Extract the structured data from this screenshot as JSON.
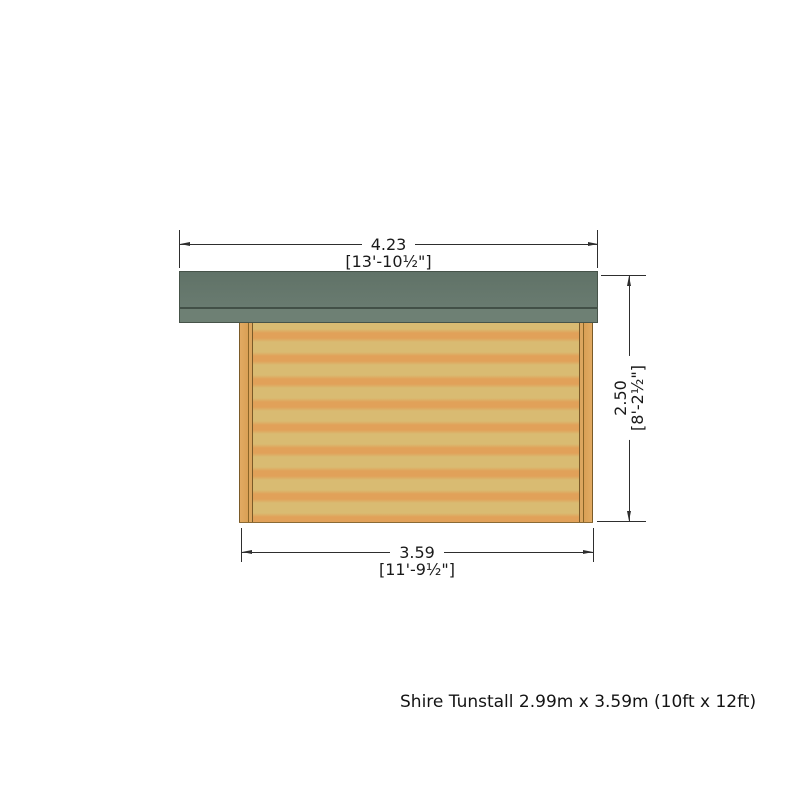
{
  "drawing": {
    "title": "side elevation of log cabin",
    "dims": {
      "top": {
        "metric": "4.23",
        "imperial": "[13'-10½\"]"
      },
      "right": {
        "metric": "2.50",
        "imperial": "[8'-2½\"]"
      },
      "bottom": {
        "metric": "3.59",
        "imperial": "[11'-9½\"]"
      }
    },
    "caption": "Shire Tunstall 2.99m x 3.59m (10ft x 12ft)",
    "colors": {
      "roof": "#697b70",
      "roof_fascia": "#6e8074",
      "roof_edge": "#465349",
      "wall_light": "#d9bb72",
      "wall_orange": "#e1a159",
      "post": "#dca65f",
      "post_edge": "#7a5a28",
      "line": "#2e2e2e",
      "text": "#1a1a1a"
    }
  }
}
